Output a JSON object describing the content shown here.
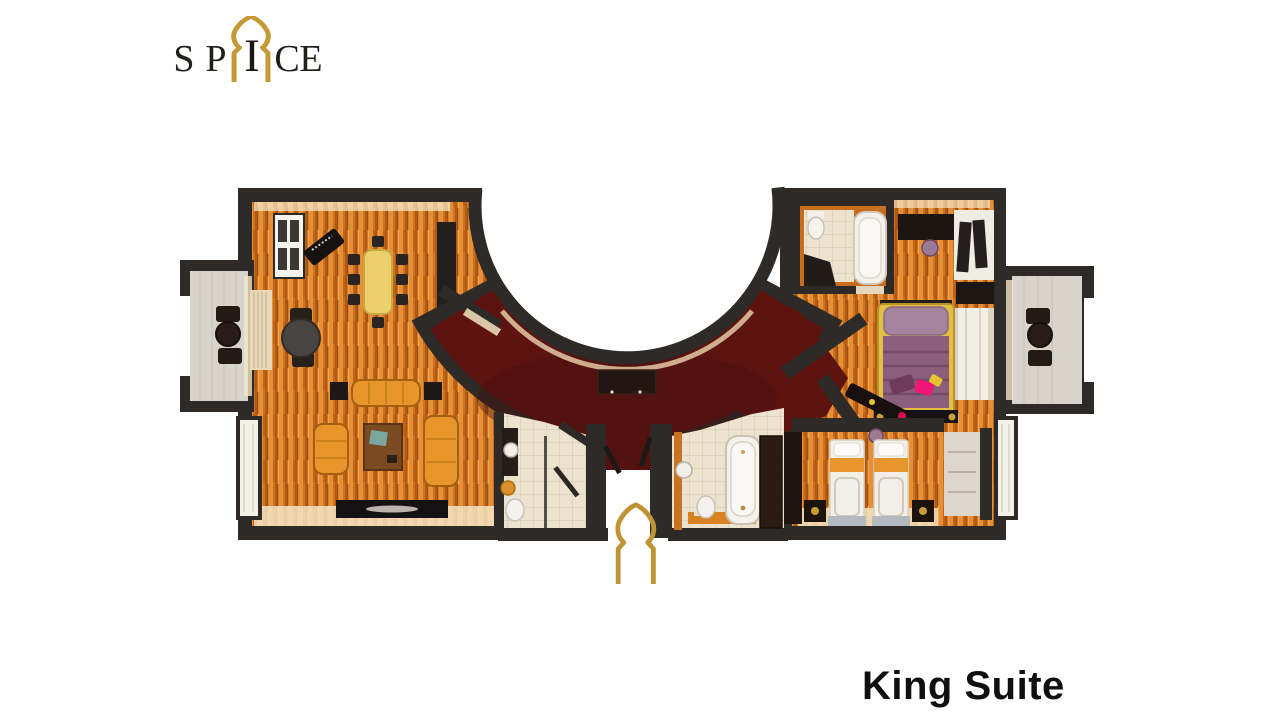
{
  "page": {
    "background_color": "#ffffff"
  },
  "logo": {
    "brand": "SPICE",
    "letters": [
      "S",
      "P",
      "I",
      "C",
      "E"
    ],
    "letter_color": "#211e1c",
    "arch_color": "#c49a34",
    "arch_icon": "moorish-arch"
  },
  "caption": {
    "text": "King Suite",
    "color": "#101010"
  },
  "floor_plan": {
    "type": "3d-rendered-top-down-floor-plan",
    "suite_name": "King Suite",
    "rooms": [
      "living-room",
      "dining-area",
      "guest-bathroom",
      "curved-corridor",
      "entrance",
      "main-bathroom",
      "master-bedroom",
      "ensuite-bathroom",
      "twin-bedroom",
      "balcony-left",
      "balcony-right"
    ],
    "colors": {
      "walls": "#2e2a28",
      "wood_floor": "#d0741e",
      "corridor_carpet": "#5d1411",
      "bathroom_tile": "#ece3cf",
      "balcony_floor": "#d8d4cb",
      "sofa_orange": "#e8962c",
      "bed_purple": "#8a5f7e",
      "bed_frame_yellow": "#e3bf45",
      "accent_gold": "#bf9434"
    }
  }
}
